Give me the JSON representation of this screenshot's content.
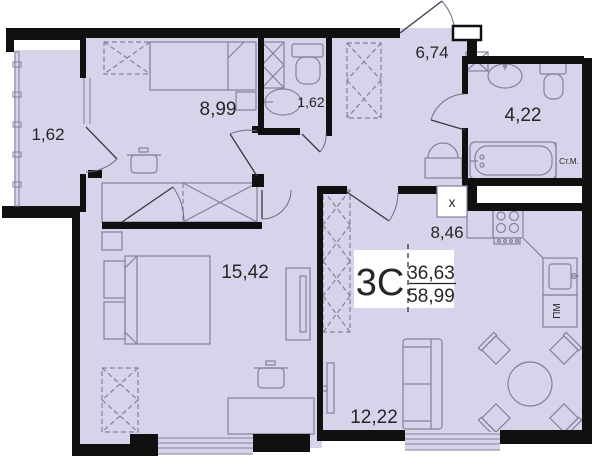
{
  "floorplan": {
    "apartment": {
      "type_label": "3С",
      "living_area": "36,63",
      "total_area": "58,99"
    },
    "rooms": [
      {
        "name": "loggia",
        "area": "1,62"
      },
      {
        "name": "bedroom-1",
        "area": "8,99"
      },
      {
        "name": "wc",
        "area": "1,62"
      },
      {
        "name": "hallway",
        "area": "6,74"
      },
      {
        "name": "bathroom",
        "area": "4,22"
      },
      {
        "name": "kitchen",
        "area": "8,46"
      },
      {
        "name": "bedroom-2",
        "area": "15,42"
      },
      {
        "name": "living-room",
        "area": "12,22"
      }
    ],
    "markings": {
      "washing_machine": "Ст.М.",
      "dishwasher": "ПМ",
      "vent_duct": "x"
    },
    "colors": {
      "floor": "#d8d2ea",
      "wall": "#101010",
      "furniture": "#83839b",
      "background": "#ffffff"
    }
  }
}
